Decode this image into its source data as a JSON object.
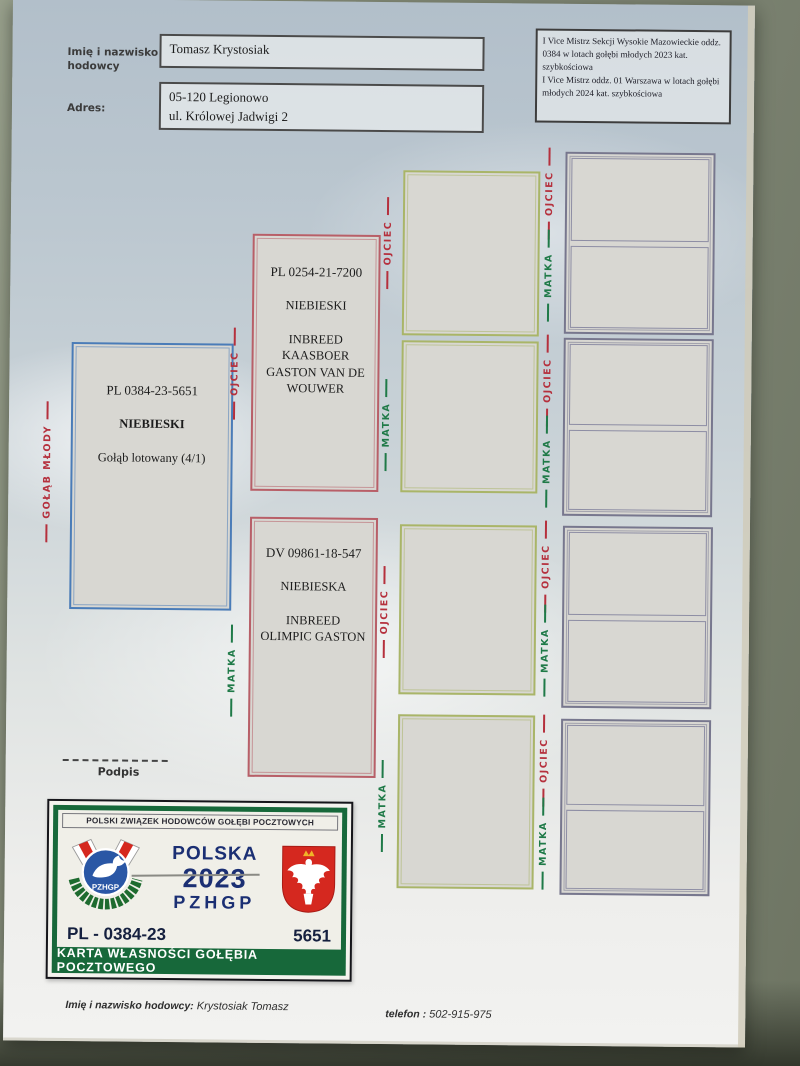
{
  "header": {
    "name_label": "Imię i nazwisko hodowcy",
    "name_value": "Tomasz Krystosiak",
    "address_label": "Adres:",
    "address_lines": [
      "05-120 Legionowo",
      "ul. Królowej Jadwigi 2"
    ],
    "achievements": [
      "I Vice Mistrz Sekcji Wysokie Mazowieckie oddz. 0384 w lotach gołębi młodych 2023 kat. szybkościowa",
      "I Vice Mistrz oddz. 01 Warszawa w lotach gołębi młodych 2024 kat. szybkościowa"
    ]
  },
  "pedigree": {
    "labels": {
      "young": "GOŁĄB MŁODY",
      "father": "OJCIEC",
      "mother": "MATKA"
    },
    "main": {
      "ring": "PL 0384-23-5651",
      "color": "NIEBIESKI",
      "note": "Gołąb lotowany (4/1)"
    },
    "father": {
      "ring": "PL 0254-21-7200",
      "color": "NIEBIESKI",
      "strain": [
        "INBREED",
        "KAASBOER",
        "GASTON VAN DE",
        "WOUWER"
      ]
    },
    "mother": {
      "ring": "DV 09861-18-547",
      "color": "NIEBIESKA",
      "strain": [
        "INBREED",
        "OLIMPIC GASTON"
      ]
    }
  },
  "signature": {
    "label": "Podpis"
  },
  "card": {
    "federation": "POLSKI ZWIĄZEK HODOWCÓW GOŁĘBI POCZTOWYCH",
    "country": "POLSKA",
    "year": "2023",
    "org": "PZHGP",
    "logo_text": "PZHGP",
    "ring_prefix": "PL - 0384-23",
    "ring_number": "5651",
    "title": "KARTA WŁASNOŚCI GOŁĘBIA POCZTOWEGO"
  },
  "footer": {
    "owner_label": "Imię i nazwisko hodowcy:",
    "owner_value": "Krystosiak Tomasz",
    "phone_label": "telefon :",
    "phone_value": "502-915-975"
  },
  "colors": {
    "young_box_border": "#4a7cb8",
    "parent_box_border": "#b85f68",
    "grandparent_box_border": "#a9b568",
    "great_grandparent_box_border": "#77778e",
    "father_label_red": "#b5303d",
    "mother_label_green": "#1f7a48",
    "card_green": "#17683a",
    "card_navy": "#1b2f73",
    "eagle_red": "#d5281f"
  }
}
